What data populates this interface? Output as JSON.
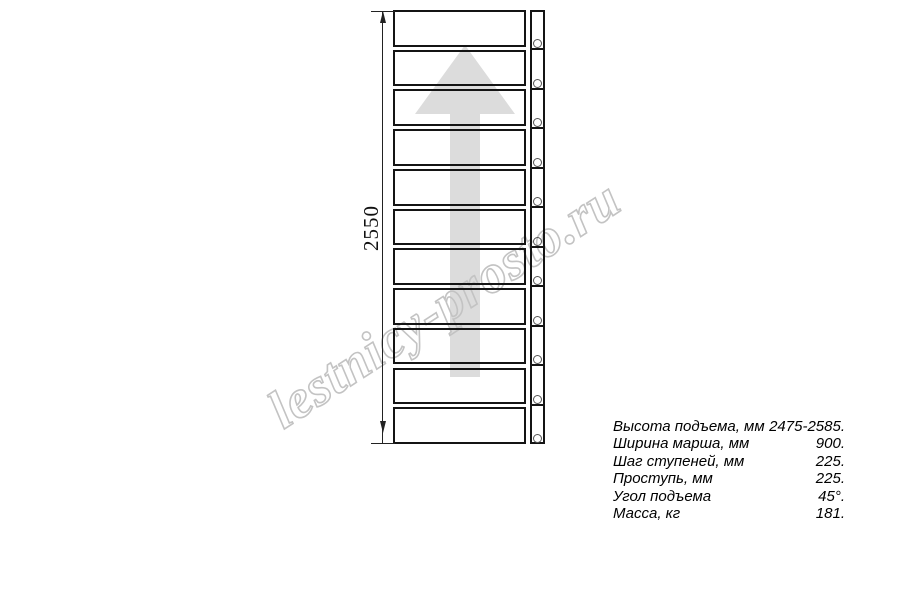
{
  "diagram": {
    "name": "straight-stair-flight-plan",
    "steps_count": 11,
    "direction_arrow": "up",
    "dimension": {
      "label": "2550"
    },
    "colors": {
      "line": "#141414",
      "arrow_fill": "#dcdcdc",
      "watermark_stroke": "#c3c3c3"
    }
  },
  "watermark": {
    "text": "lestnicy-prosto.ru"
  },
  "specs": {
    "rows": [
      {
        "label": "Высота подъема, мм",
        "value": "2475-2585."
      },
      {
        "label": "Ширина марша, мм",
        "value": "900."
      },
      {
        "label": "Шаг ступеней, мм",
        "value": "225."
      },
      {
        "label": "Проступь, мм",
        "value": "225."
      },
      {
        "label": "Угол подъема",
        "value": "45°."
      },
      {
        "label": "Масса, кг",
        "value": "181."
      }
    ]
  }
}
